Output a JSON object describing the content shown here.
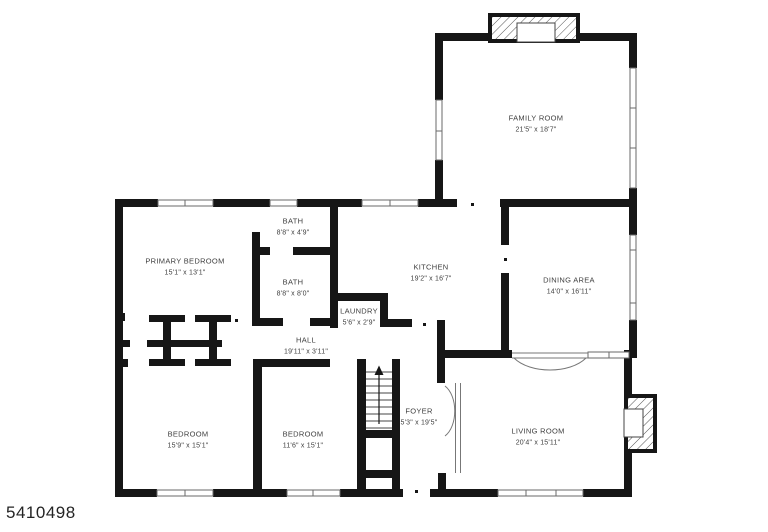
{
  "plan_id": "5410498",
  "rooms": [
    {
      "name": "FAMILY ROOM",
      "dims": "21'5\" x 18'7\""
    },
    {
      "name": "BATH",
      "dims": "8'8\" x 4'9\""
    },
    {
      "name": "PRIMARY BEDROOM",
      "dims": "15'1\" x 13'1\""
    },
    {
      "name": "BATH",
      "dims": "8'8\" x 8'0\""
    },
    {
      "name": "KITCHEN",
      "dims": "19'2\" x 16'7\""
    },
    {
      "name": "DINING AREA",
      "dims": "14'0\" x 16'11\""
    },
    {
      "name": "LAUNDRY",
      "dims": "5'6\" x 2'9\""
    },
    {
      "name": "HALL",
      "dims": "19'11\" x 3'11\""
    },
    {
      "name": "BEDROOM",
      "dims": "15'9\" x 15'1\""
    },
    {
      "name": "BEDROOM",
      "dims": "11'6\" x 15'1\""
    },
    {
      "name": "FOYER",
      "dims": "5'3\" x 19'5\""
    },
    {
      "name": "LIVING ROOM",
      "dims": "20'4\" x 15'11\""
    }
  ],
  "colors": {
    "wall": "#161616",
    "label": "#3f3f3f",
    "background": "#ffffff"
  }
}
